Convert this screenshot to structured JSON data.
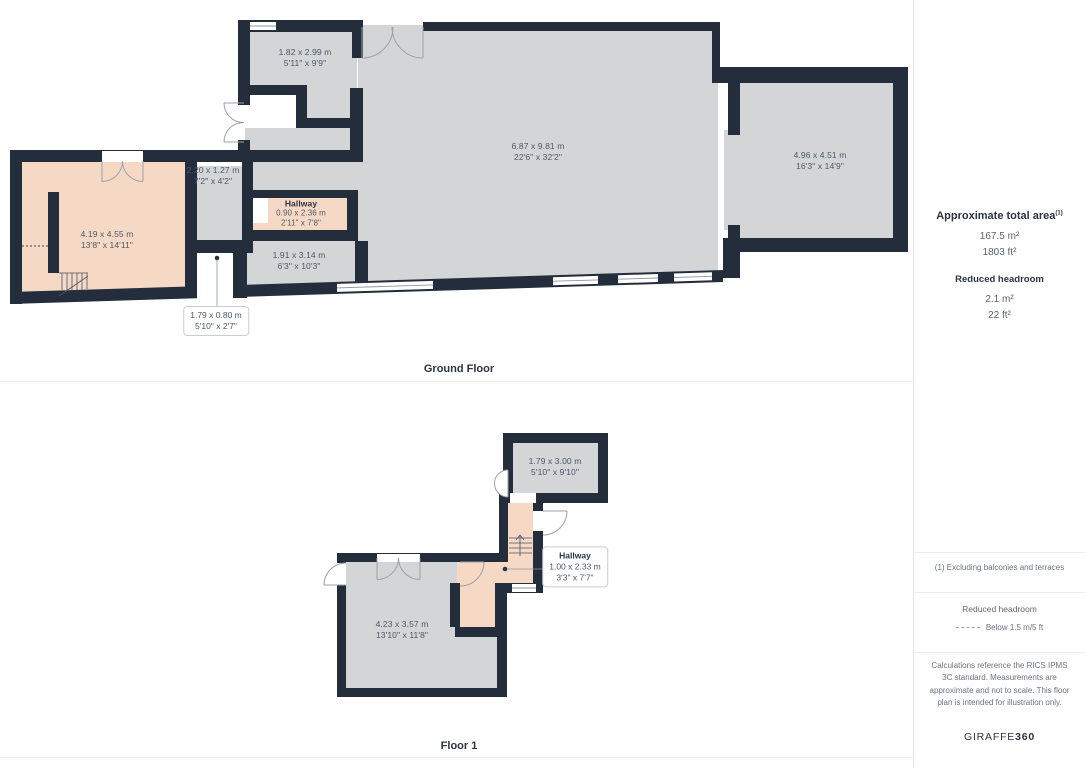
{
  "ground_floor": {
    "title": "Ground Floor",
    "rooms": [
      {
        "metric": "1.82 x 2.99 m",
        "imperial": "5'11\" x 9'9\""
      },
      {
        "metric": "6.87 x 9.81 m",
        "imperial": "22'6\" x 32'2\""
      },
      {
        "metric": "4.96 x 4.51 m",
        "imperial": "16'3\" x 14'9\""
      },
      {
        "metric": "2.20 x 1.27 m",
        "imperial": "7'2\" x 4'2\""
      },
      {
        "name": "Hallway",
        "metric": "0.90 x 2.36 m",
        "imperial": "2'11\" x 7'8\""
      },
      {
        "metric": "4.19 x 4.55 m",
        "imperial": "13'8\" x 14'11\""
      },
      {
        "metric": "1.91 x 3.14 m",
        "imperial": "6'3\" x 10'3\""
      },
      {
        "metric": "1.79 x 0.80 m",
        "imperial": "5'10\" x 2'7\""
      }
    ]
  },
  "floor_1": {
    "title": "Floor 1",
    "rooms": [
      {
        "metric": "1.79 x 3.00 m",
        "imperial": "5'10\" x 9'10\""
      },
      {
        "name": "Hallway",
        "metric": "1.00 x 2.33 m",
        "imperial": "3'3\" x 7'7\""
      },
      {
        "metric": "4.23 x 3.57 m",
        "imperial": "13'10\" x 11'8\""
      }
    ]
  },
  "sidebar": {
    "total_area": {
      "heading": "Approximate total area",
      "footnote_marker": "(1)",
      "metric": "167.5 m²",
      "imperial": "1803 ft²"
    },
    "reduced_headroom": {
      "heading": "Reduced headroom",
      "metric": "2.1 m²",
      "imperial": "22 ft²"
    },
    "footnote": "(1) Excluding balconies and terraces",
    "legend": {
      "label": "Reduced headroom",
      "value": "Below 1.5 m/5 ft"
    },
    "disclaimer": "Calculations reference the RICS IPMS 3C standard. Measurements are approximate and not to scale. This floor plan is intended for illustration only.",
    "brand": {
      "name": "GIRAFFE",
      "suffix": "360"
    }
  },
  "colors": {
    "wall": "#242d3c",
    "room_gray": "#d3d5d7",
    "room_salmon": "#f6d9c5",
    "label_text": "#4d5868"
  }
}
